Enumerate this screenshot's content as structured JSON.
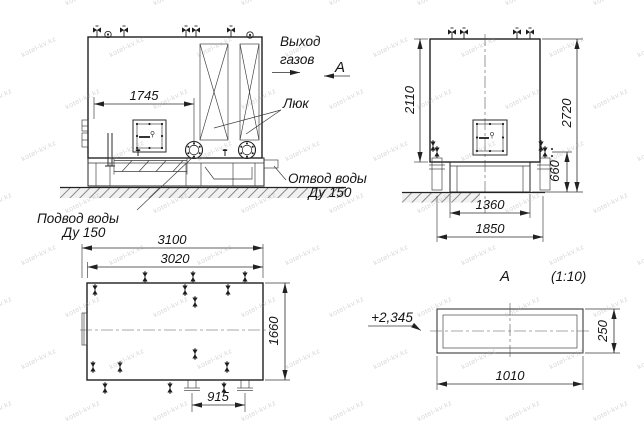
{
  "watermark": {
    "text": "kotel-kv.kz"
  },
  "labels": {
    "gas_outlet_line1": "Выход",
    "gas_outlet_line2": "газов",
    "view_marker": "А",
    "hatch": "Люк",
    "water_outlet_line1": "Отвод воды",
    "water_outlet_line2": "Ду 150",
    "water_inlet_line1": "Подвод воды",
    "water_inlet_line2": "Ду 150",
    "section_title": "А",
    "section_scale": "(1:10)",
    "elevation_mark": "+2,345"
  },
  "dimensions": {
    "front_width": "1745",
    "side_shell_height": "2110",
    "side_total_height": "2720",
    "side_base_height": "660",
    "side_base_width": "1360",
    "side_overall_width": "1850",
    "plan_length_overall": "3100",
    "plan_length_shell": "3020",
    "plan_width": "1660",
    "plan_flange_spacing": "915",
    "section_width": "1010",
    "section_height": "250"
  }
}
